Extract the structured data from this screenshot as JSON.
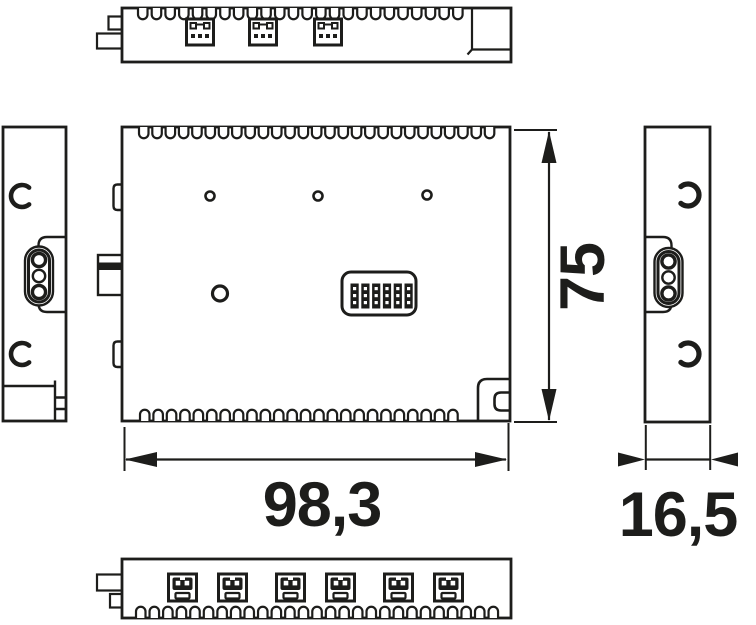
{
  "drawing": {
    "background_color": "#ffffff",
    "line_color": "#1d1d1b",
    "dimensions": {
      "width_label": "98,3",
      "height_label": "75",
      "depth_label": "16,5"
    }
  }
}
